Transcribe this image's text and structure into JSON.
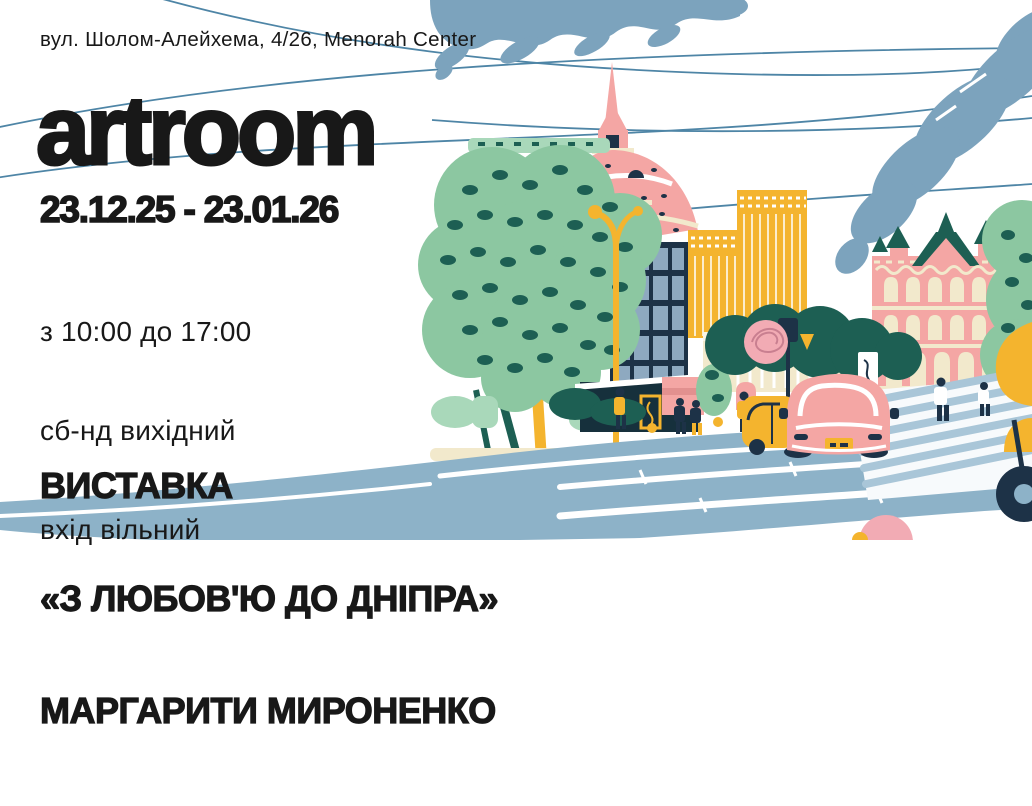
{
  "poster": {
    "address": "вул. Шолом-Алейхема, 4/26, Menorah Center",
    "brand": "artroom",
    "dates": "23.12.25 - 23.01.26",
    "schedule": {
      "hours": "з 10:00 до 17:00",
      "weekend": "сб-нд вихідний",
      "admission": "вхід вільний"
    },
    "exhibition": {
      "label": "ВИСТАВКА",
      "title": "«З ЛЮБОВ'Ю ДО ДНІПРА»",
      "artist": "МАРГАРИТИ МИРОНЕНКО"
    }
  },
  "illustration": {
    "elements": [
      "clouds",
      "power-lines",
      "domed-building",
      "glass-tower",
      "yellow-highrises",
      "classical-pink-building",
      "trees",
      "street-lamp",
      "traffic-light",
      "pedestrians",
      "pink-car",
      "yellow-taxi",
      "scooter",
      "crosswalk",
      "road"
    ]
  },
  "colors": {
    "background": "#ffffff",
    "text": "#181818",
    "cloud_blue": "#7ca3bd",
    "wire_blue": "#4e85a6",
    "road_blue": "#8db2c8",
    "stripe_blue": "#a9c6d8",
    "glass_blue": "#8ea9c0",
    "tree_green": "#8cc7a1",
    "mint_green": "#a9d8ba",
    "deep_teal": "#1d5f53",
    "pink": "#f4a6a4",
    "light_pink": "#f2abb4",
    "yellow": "#f4b42e",
    "cream": "#f2e9cc",
    "navy": "#1d3247"
  }
}
